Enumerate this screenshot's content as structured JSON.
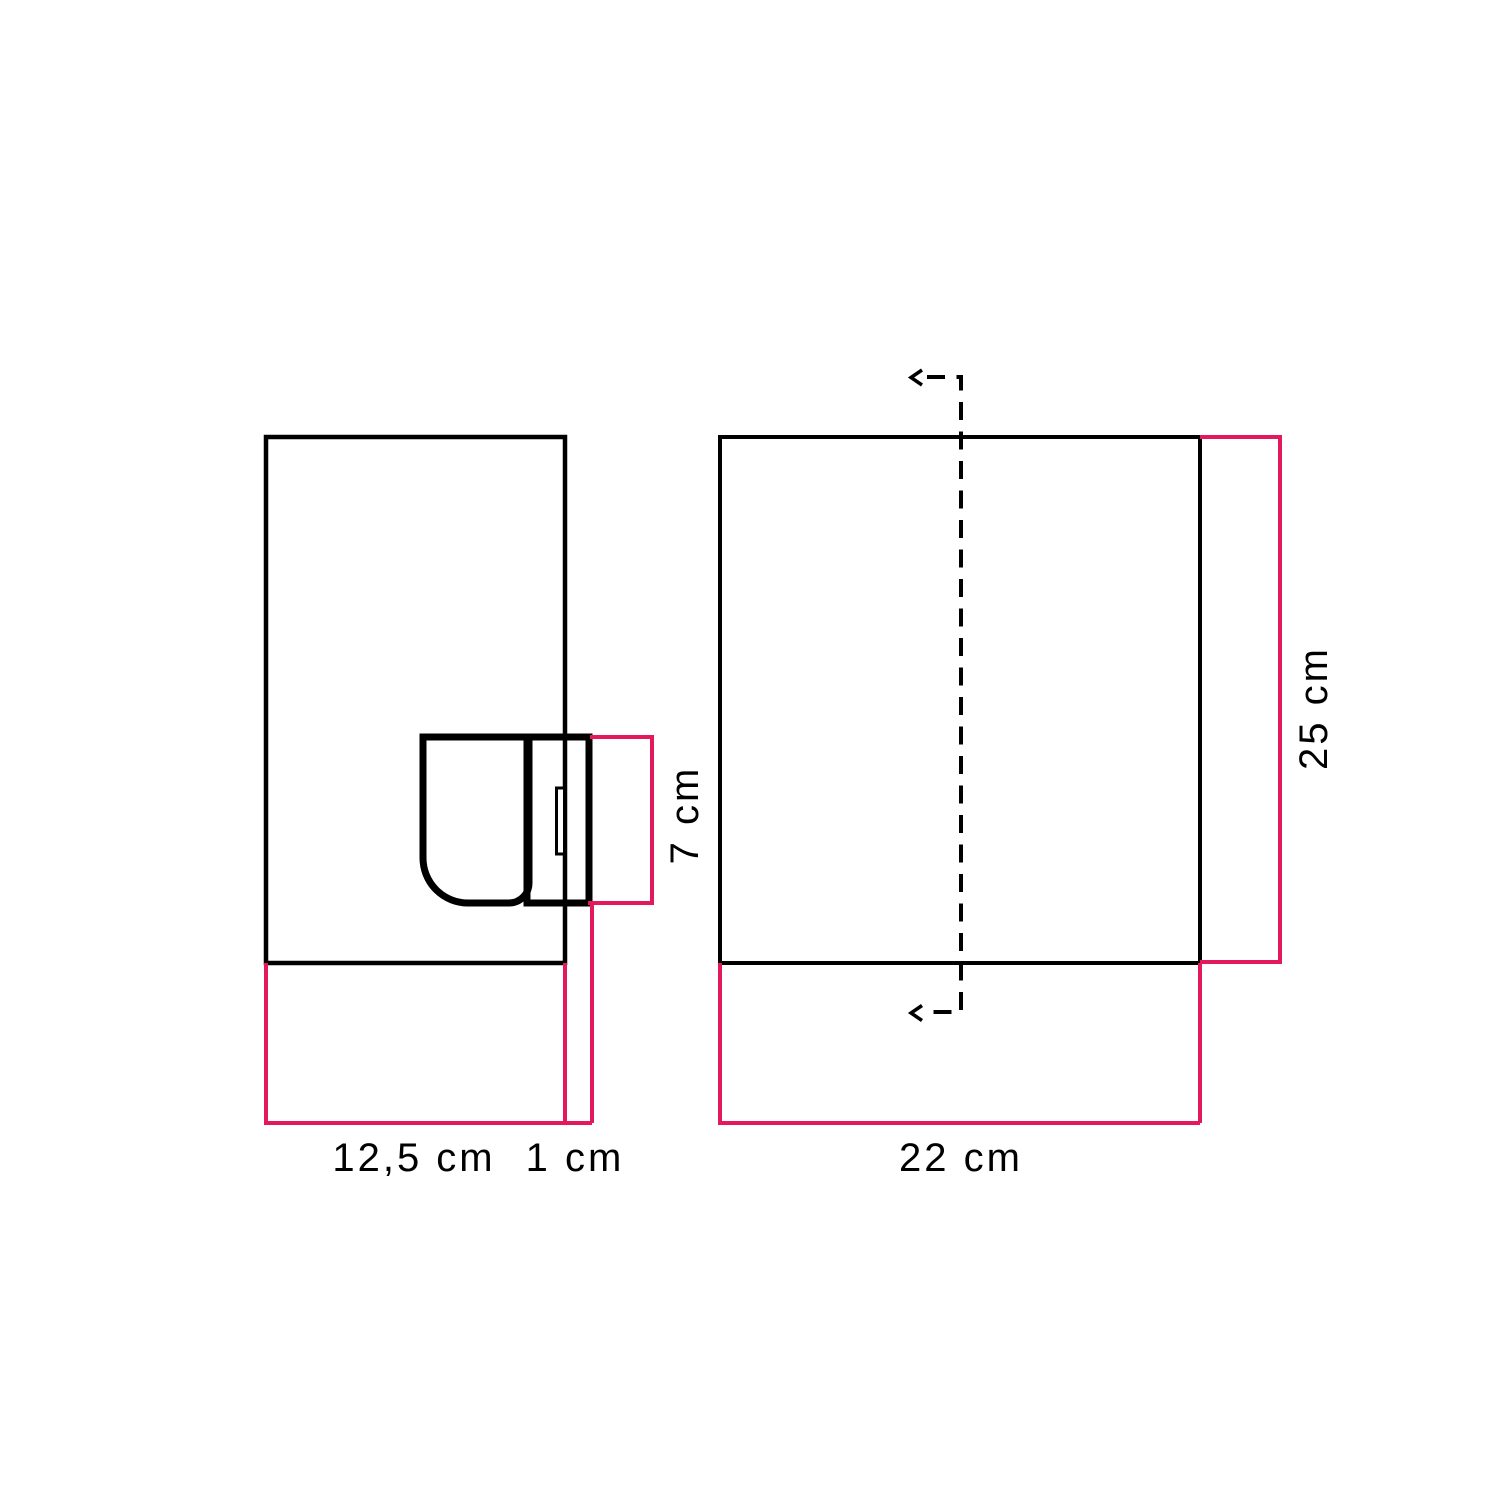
{
  "colors": {
    "outline": "#000000",
    "dimension_line": "#e4195c",
    "label_text": "#000000",
    "background": "#ffffff"
  },
  "side_view": {
    "labels": {
      "depth": "12,5 cm",
      "plate": "1 cm",
      "socket": "7 cm"
    }
  },
  "front_view": {
    "labels": {
      "width": "22 cm",
      "height": "25 cm"
    }
  }
}
